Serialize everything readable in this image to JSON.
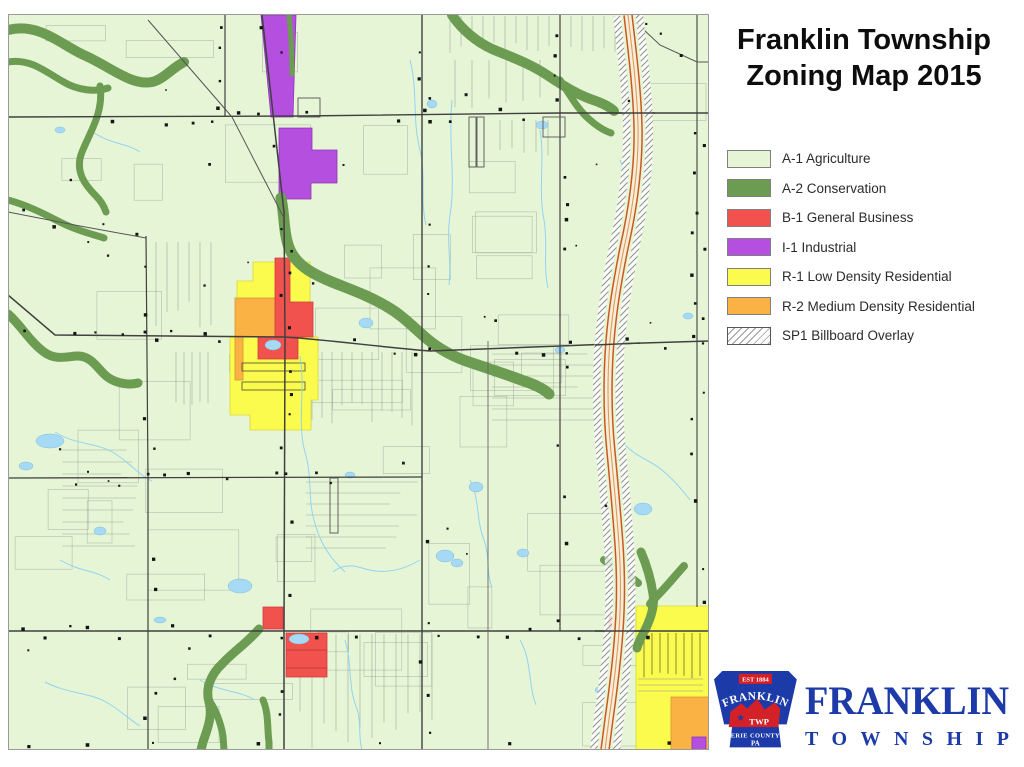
{
  "title": {
    "line1": "Franklin Township",
    "line2": "Zoning Map 2015"
  },
  "legend": {
    "items": [
      {
        "code": "A-1",
        "label": "A-1 Agriculture",
        "color": "#e7f5d7"
      },
      {
        "code": "A-2",
        "label": "A-2 Conservation",
        "color": "#6b9c52"
      },
      {
        "code": "B-1",
        "label": "B-1 General Business",
        "color": "#f2524d"
      },
      {
        "code": "I-1",
        "label": "I-1 Industrial",
        "color": "#b44fe0"
      },
      {
        "code": "R-1",
        "label": "R-1 Low Density Residential",
        "color": "#fbfb4e"
      },
      {
        "code": "R-2",
        "label": "R-2 Medium Density Residential",
        "color": "#fbb245"
      },
      {
        "code": "SP1",
        "label": "SP1 Billboard Overlay",
        "color": "#ffffff",
        "pattern": "diagonal-hatch"
      }
    ]
  },
  "logo": {
    "est": "EST 1884",
    "keystone_name": "FRANKLIN",
    "twp": "TWP",
    "county": "ERIE COUNTY",
    "state": "PA",
    "wordmark_line1": "FRANKLIN",
    "wordmark_line2": "TOWNSHIP",
    "blue": "#1c3aa8",
    "red": "#d42027"
  },
  "map": {
    "background": "#e7f5d7",
    "water": "#a6daf4",
    "road": "#3c3c3c",
    "highway": "#c8581f",
    "conservation": "#6b9c52"
  }
}
